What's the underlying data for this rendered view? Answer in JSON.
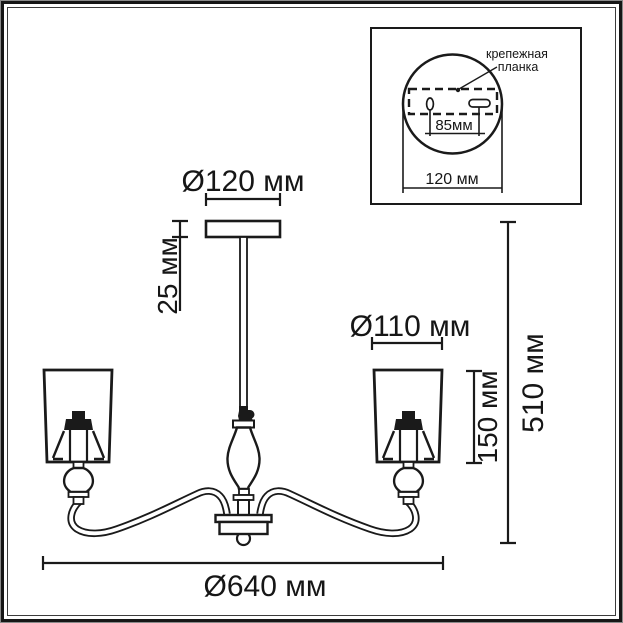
{
  "diagram": {
    "title": "chandelier-dimension-drawing",
    "dims": {
      "canopy_diameter": "Ø120 мм",
      "canopy_height": "25 мм",
      "shade_diameter": "Ø110 мм",
      "shade_height": "150 мм",
      "fixture_height": "510 мм",
      "fixture_diameter": "Ø640 мм"
    },
    "inset": {
      "label_line1": "крепежная",
      "label_line2": "планка",
      "holes_spacing": "85мм",
      "plate_width": "120 мм"
    },
    "colors": {
      "line": "#1a1a1a",
      "background": "#ffffff"
    }
  }
}
